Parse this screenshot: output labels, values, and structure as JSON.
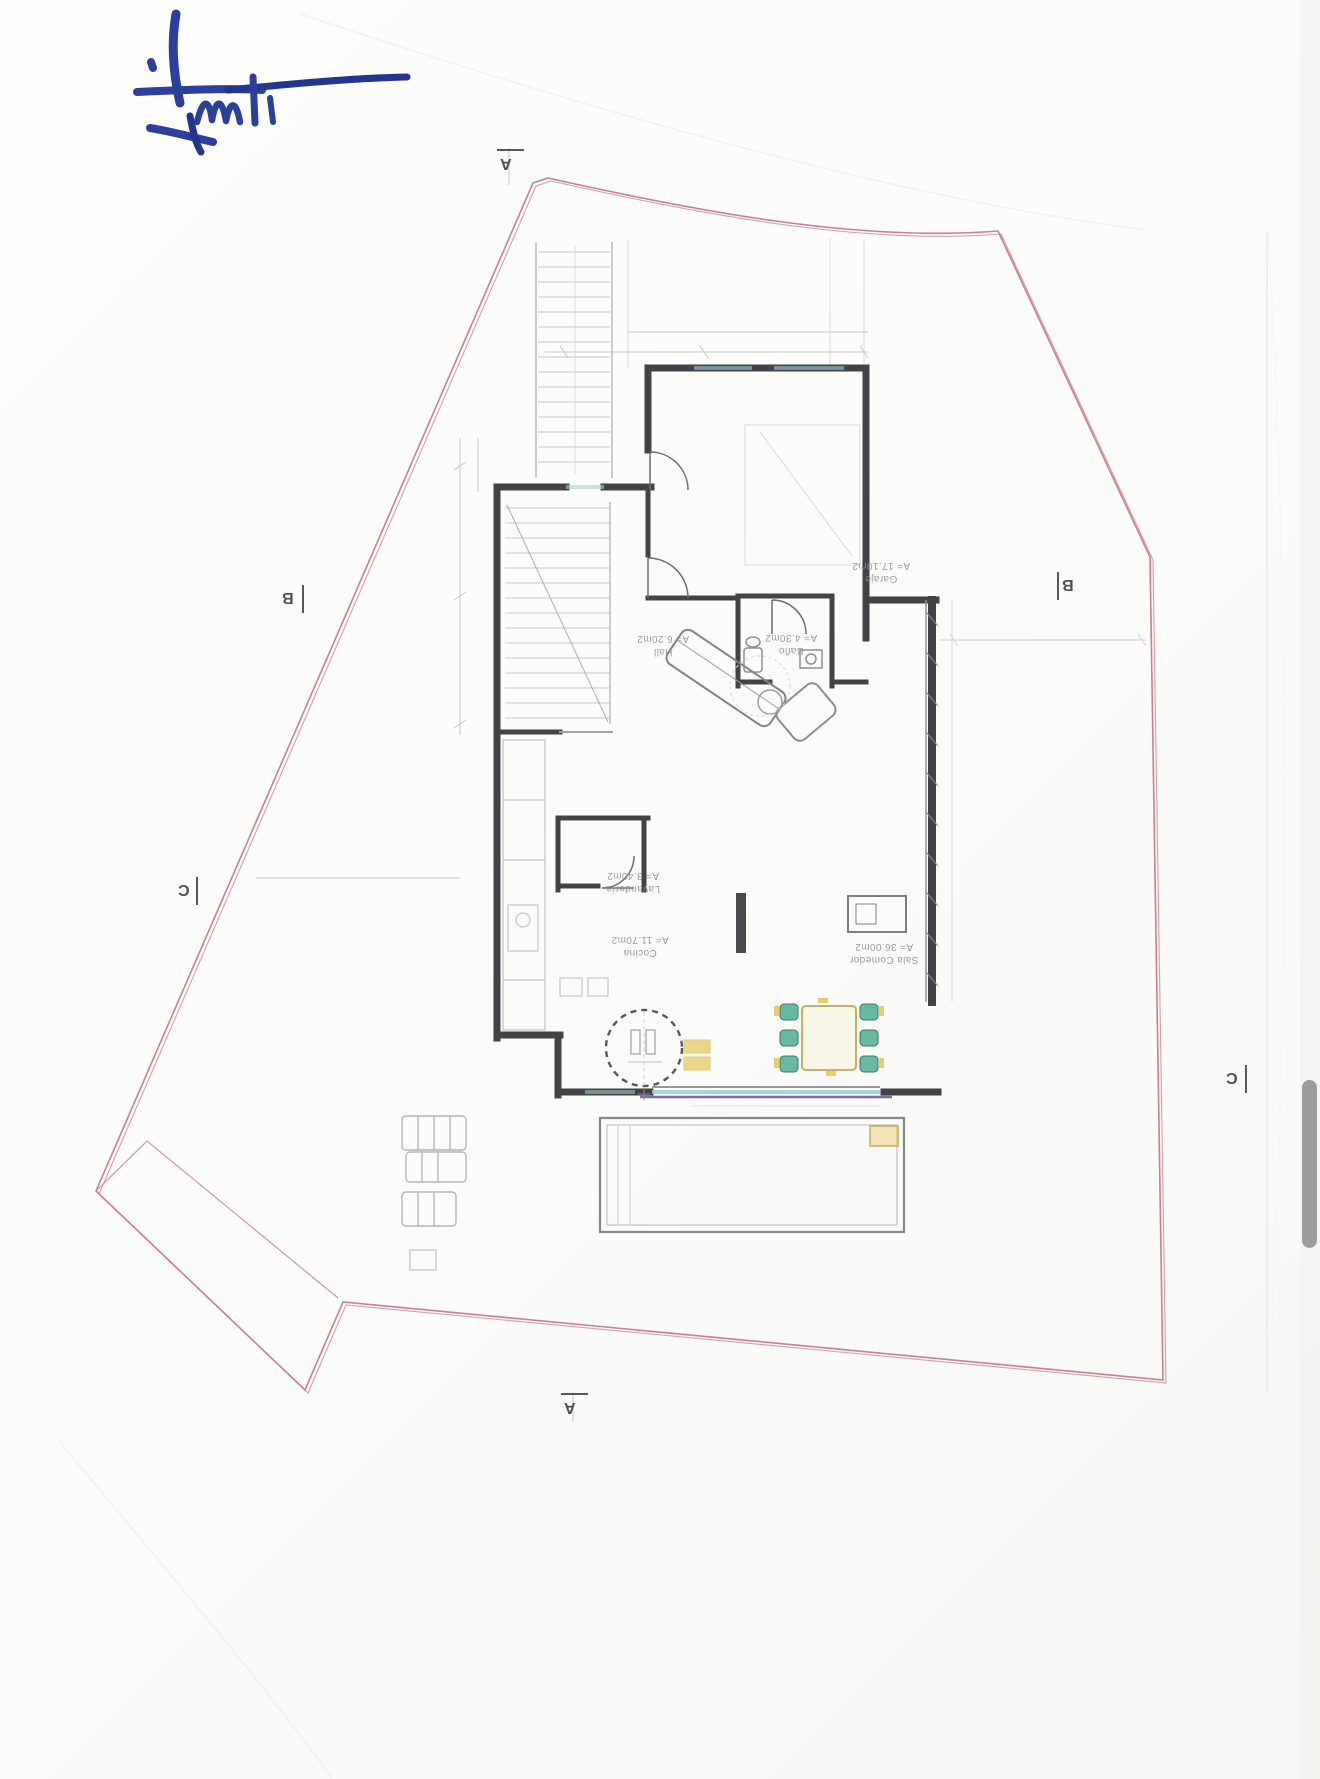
{
  "plan": {
    "rooms": [
      {
        "name": "Garaje",
        "area": "A= 17.10m2"
      },
      {
        "name": "Hall",
        "area": "A= 6.20m2"
      },
      {
        "name": "Baño",
        "area": "A= 4.30m2"
      },
      {
        "name": "Lavandería",
        "area": "A= 3.40m2"
      },
      {
        "name": "Cocina",
        "area": "A= 11.70m2"
      },
      {
        "name": "Sala Comedor",
        "area": "A= 36.00m2"
      }
    ],
    "section_markers": [
      {
        "label": "A",
        "edge": "top"
      },
      {
        "label": "B",
        "edge": "left"
      },
      {
        "label": "B",
        "edge": "right"
      },
      {
        "label": "C",
        "edge": "left"
      },
      {
        "label": "C",
        "edge": "right"
      },
      {
        "label": "A",
        "edge": "bottom"
      }
    ]
  },
  "colors": {
    "boundary_pink": "#c9808c",
    "wall_dark": "#434347",
    "label_gray": "#8d929a",
    "signature_blue": "#2c3f9d",
    "chair_teal": "#3aa086",
    "highlight_yellow": "#e4c250",
    "glazing_cyan": "#8ed5d6",
    "glazing_purple": "#6f4fa0",
    "scrollbar_gray": "#9c9c9f"
  }
}
